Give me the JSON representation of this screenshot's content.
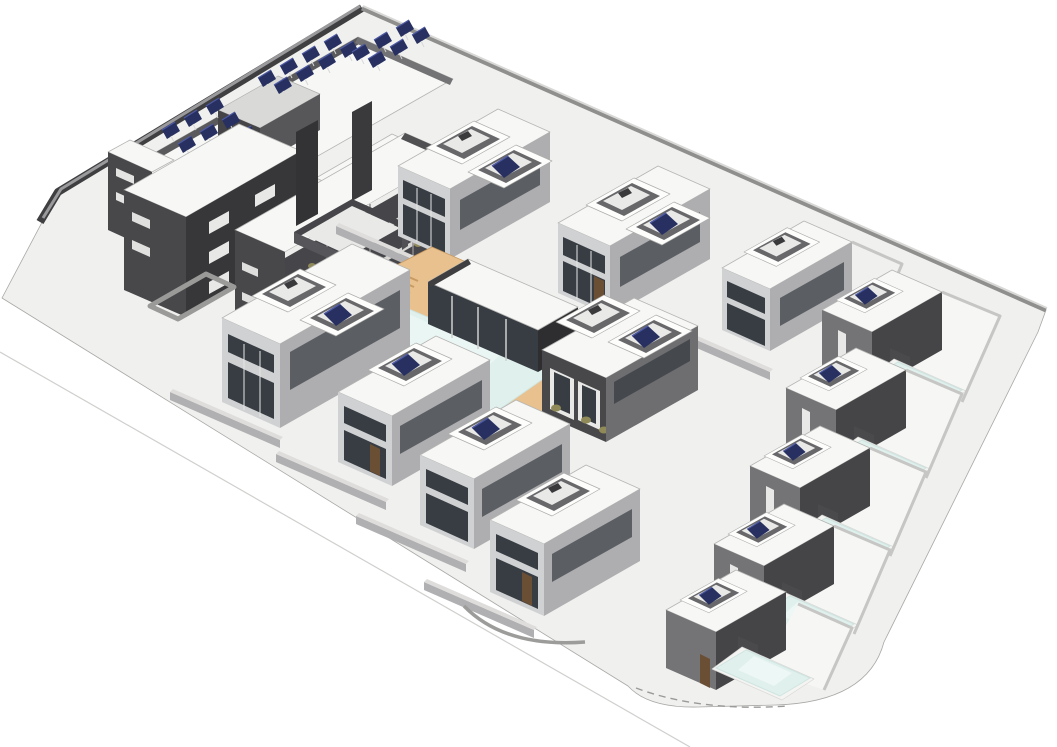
{
  "meta": {
    "title": "3D axonometric site model of a residential compound",
    "description": "BIM-style rendering: dark L-shaped apartment block with rooftop solar arrays and planted balconies, a row of white two-storey townhouses, detached villas with private pools along the east edge, and a communal L-shaped pool with tan timber deck and glazed pool pavilion, all on a pale site platform with perimeter walls.",
    "visible_text": ""
  },
  "colors": {
    "bg": "#ffffff",
    "ground": "#f0f0ee",
    "roof": "#f7f7f6",
    "dkSW": "#48484b",
    "dkSE": "#37373a",
    "ltSW": "#cfd1d3",
    "ltSE": "#aeaeb0",
    "glass": "#383d43",
    "deck": "#e8c18e",
    "deckline": "#c99a62",
    "pool": "#dff0ed",
    "solar": "#273060",
    "solarlt": "#4c58a2",
    "plant": "#908a58",
    "villaSW": "#747477",
    "villaSE": "#454548",
    "parapet": "#b5b5b3",
    "band": "#d6d6d4",
    "pit": "#68686b",
    "floor": "#e9e9e8",
    "gwall": "#b0b0b2",
    "gwalltop": "#dedddb",
    "shed": "#4a4a4d",
    "door": "#6b4f35",
    "line": "#9d9d9b"
  },
  "scene": {
    "site": {
      "platform": "pale gray parallelogram with rounded south-east corner",
      "boundary": [
        "dark north-west perimeter wall",
        "gray north-east perimeter wall",
        "white entrance gate panel at west corner"
      ]
    },
    "buildings": {
      "apartment_block": {
        "label": "three-storey apartment building",
        "facade": "dark charcoal",
        "balcony_floors": 3,
        "solar_arrays": 3,
        "solar_panels": 23
      },
      "townhouses_top_row": {
        "label": "two-storey white townhouses",
        "structures": 3,
        "rooftop_skylight_openings": 5,
        "skylights_with_solar_panel": 2
      },
      "center_duplex": {
        "label": "duplex with planted terraces",
        "units": 2,
        "skylights_with_solar_panel": 1
      },
      "houses_center_row": {
        "label": "two-storey houses along communal pool",
        "structures": 4,
        "skylights_with_solar_panel": 3
      },
      "villas_east_column": {
        "label": "detached villas with private pools",
        "count": 5,
        "private_pools": 5
      },
      "pool_pavilion": {
        "label": "single-storey glazed pool house",
        "roof": "white slab"
      }
    },
    "amenities": {
      "communal_pool": {
        "shape": "L-shaped",
        "water": "#dff0ed",
        "deck": "tan timber"
      },
      "private_pool_water": "#dff0ed",
      "balcony_planting": "olive shrubs"
    }
  }
}
